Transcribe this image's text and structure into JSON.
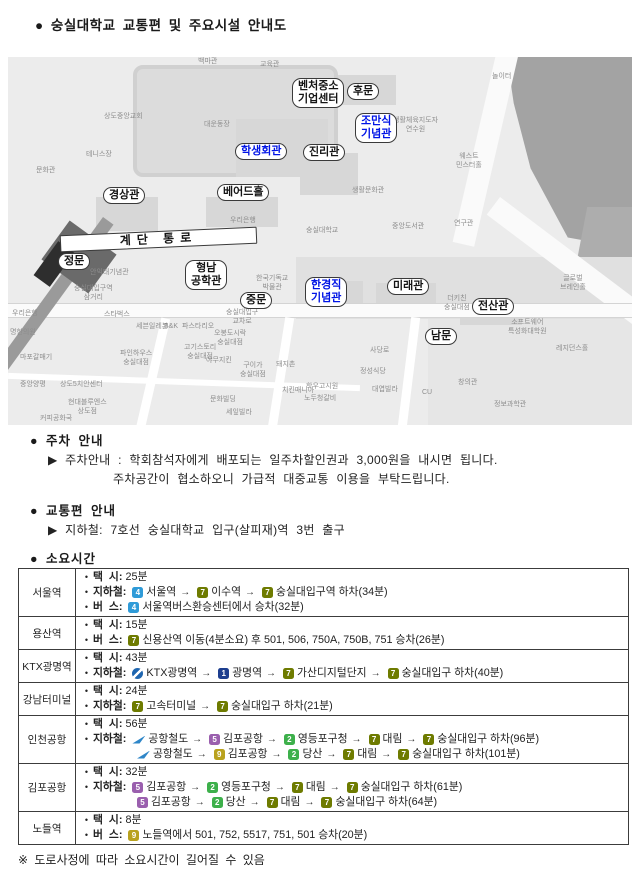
{
  "title": "● 숭실대학교 교통편 및 주요시설 안내도",
  "sections": {
    "parking": {
      "header": "● 주차 안내",
      "line1": "▶ 주차안내 : 학회참석자에게 배포되는 일주차할인권과 3,000원을 내시면 됩니다.",
      "line2": "주차공간이 협소하오니 가급적 대중교통 이용을 부탁드립니다."
    },
    "transport": {
      "header": "● 교통편 안내",
      "line1": "▶ 지하철: 7호선 숭실대학교 입구(살피재)역 3번 출구"
    },
    "duration": {
      "header": "● 소요시간"
    }
  },
  "footnote": "※ 도로사정에 따라 소요시간이 길어질 수 있음",
  "line_colors": {
    "1": "#1d3e8f",
    "2": "#3db04b",
    "4": "#2f9bd8",
    "5": "#9a5fae",
    "7": "#6e7b00",
    "9": "#b9a21e"
  },
  "map": {
    "highlight_color": "#0014e6",
    "boxes": [
      {
        "x": 284,
        "y": 21,
        "t": "벤처중소\n기업센터"
      },
      {
        "x": 339,
        "y": 26,
        "t": "후문"
      },
      {
        "x": 347,
        "y": 56,
        "t": "조만식\n기념관",
        "blue": true
      },
      {
        "x": 227,
        "y": 86,
        "t": "학생회관",
        "blue": true
      },
      {
        "x": 295,
        "y": 87,
        "t": "진리관"
      },
      {
        "x": 95,
        "y": 130,
        "t": "경상관"
      },
      {
        "x": 209,
        "y": 127,
        "t": "베어드홀"
      },
      {
        "x": 52,
        "y": 174,
        "w": 197,
        "t": "계단 통로",
        "banner": true
      },
      {
        "x": 50,
        "y": 196,
        "t": "정문"
      },
      {
        "x": 177,
        "y": 203,
        "t": "형남\n공학관"
      },
      {
        "x": 232,
        "y": 235,
        "t": "중문"
      },
      {
        "x": 297,
        "y": 220,
        "t": "한경직\n기념관",
        "blue": true
      },
      {
        "x": 379,
        "y": 221,
        "t": "미래관"
      },
      {
        "x": 464,
        "y": 241,
        "t": "전산관"
      },
      {
        "x": 417,
        "y": 271,
        "t": "남문"
      }
    ],
    "bg_labels": [
      {
        "x": 190,
        "y": 1,
        "t": "백마관"
      },
      {
        "x": 252,
        "y": 4,
        "t": "교육관"
      },
      {
        "x": 96,
        "y": 56,
        "t": "상도중앙교회"
      },
      {
        "x": 196,
        "y": 64,
        "t": "대운동장"
      },
      {
        "x": 78,
        "y": 94,
        "t": "테니스장"
      },
      {
        "x": 28,
        "y": 110,
        "t": "문화관"
      },
      {
        "x": 484,
        "y": 16,
        "t": "놀이터"
      },
      {
        "x": 385,
        "y": 60,
        "t": "생활체육지도자\n연수원"
      },
      {
        "x": 448,
        "y": 96,
        "t": "웨스트\n민스터홀"
      },
      {
        "x": 344,
        "y": 130,
        "t": "생활문화관"
      },
      {
        "x": 384,
        "y": 166,
        "t": "중앙도서관"
      },
      {
        "x": 446,
        "y": 163,
        "t": "연구관"
      },
      {
        "x": 222,
        "y": 160,
        "t": "우리은행"
      },
      {
        "x": 298,
        "y": 170,
        "t": "숭실대학교"
      },
      {
        "x": 82,
        "y": 212,
        "t": "안익태기념관"
      },
      {
        "x": 66,
        "y": 228,
        "t": "숭실대입구역\n삼거리"
      },
      {
        "x": 248,
        "y": 218,
        "t": "한국기독교\n박물관"
      },
      {
        "x": 218,
        "y": 252,
        "t": "숭실대입구\n교차로"
      },
      {
        "x": 96,
        "y": 254,
        "t": "스타벅스"
      },
      {
        "x": 552,
        "y": 218,
        "t": "글로벌\n브레인홀"
      },
      {
        "x": 500,
        "y": 262,
        "t": "소프트웨어\n특성화대학원"
      },
      {
        "x": 548,
        "y": 288,
        "t": "레지던스홀"
      },
      {
        "x": 436,
        "y": 238,
        "t": "더키친\n숭실대점"
      },
      {
        "x": 362,
        "y": 290,
        "t": "사당로"
      },
      {
        "x": 4,
        "y": 253,
        "t": "우리은행"
      },
      {
        "x": 2,
        "y": 272,
        "t": "명한의원"
      },
      {
        "x": 12,
        "y": 297,
        "t": "마포갈매기"
      },
      {
        "x": 12,
        "y": 324,
        "t": "중앙양평"
      },
      {
        "x": 52,
        "y": 324,
        "t": "상도5치안센터"
      },
      {
        "x": 60,
        "y": 342,
        "t": "현대블루엔스\n상도점"
      },
      {
        "x": 32,
        "y": 358,
        "t": "커피공화국"
      },
      {
        "x": 128,
        "y": 266,
        "t": "세븐일레븐"
      },
      {
        "x": 156,
        "y": 266,
        "t": "B&K"
      },
      {
        "x": 174,
        "y": 266,
        "t": "파스타리오"
      },
      {
        "x": 206,
        "y": 273,
        "t": "오봉도시락\n숭실대점"
      },
      {
        "x": 176,
        "y": 287,
        "t": "고기스토리\n숭실대점"
      },
      {
        "x": 198,
        "y": 300,
        "t": "야무지킨"
      },
      {
        "x": 232,
        "y": 305,
        "t": "구이가\n숭실대점"
      },
      {
        "x": 268,
        "y": 304,
        "t": "돼지촌"
      },
      {
        "x": 112,
        "y": 293,
        "t": "파인하우스\n숭실대점"
      },
      {
        "x": 274,
        "y": 330,
        "t": "치킨매니아"
      },
      {
        "x": 296,
        "y": 338,
        "t": "노두청갈비"
      },
      {
        "x": 202,
        "y": 339,
        "t": "문화빌딩"
      },
      {
        "x": 298,
        "y": 326,
        "t": "학우고시원"
      },
      {
        "x": 352,
        "y": 311,
        "t": "정성식당"
      },
      {
        "x": 364,
        "y": 329,
        "t": "대엽빌라"
      },
      {
        "x": 218,
        "y": 352,
        "t": "세잎빌라"
      },
      {
        "x": 450,
        "y": 322,
        "t": "창의관"
      },
      {
        "x": 486,
        "y": 344,
        "t": "정보과학관"
      },
      {
        "x": 414,
        "y": 332,
        "t": "CU"
      }
    ]
  },
  "table": {
    "rows": [
      {
        "station": "서울역",
        "lines": [
          {
            "bullet": true,
            "label": "택  시:",
            "parts": [
              {
                "text": "25분"
              }
            ]
          },
          {
            "bullet": true,
            "label": "지하철:",
            "parts": [
              {
                "badge": "4"
              },
              {
                "text": "서울역"
              },
              {
                "arrow": "→"
              },
              {
                "badge": "7"
              },
              {
                "text": "이수역"
              },
              {
                "arrow": "→"
              },
              {
                "badge": "7"
              },
              {
                "text": "숭실대입구역 하차(34분)"
              }
            ]
          },
          {
            "bullet": true,
            "label": "버  스:",
            "parts": [
              {
                "badge": "4"
              },
              {
                "text": "서울역버스환승센터에서 승차(32분)"
              }
            ]
          }
        ]
      },
      {
        "station": "용산역",
        "lines": [
          {
            "bullet": true,
            "label": "택  시:",
            "parts": [
              {
                "text": "15분"
              }
            ]
          },
          {
            "bullet": true,
            "label": "버  스:",
            "parts": [
              {
                "badge": "7"
              },
              {
                "text": "신용산역 이동(4분소요) 후 501, 506, 750A, 750B, 751 승차(26분)"
              }
            ]
          }
        ]
      },
      {
        "station": "KTX광명역",
        "lines": [
          {
            "bullet": true,
            "label": "택  시:",
            "parts": [
              {
                "text": "43분"
              }
            ]
          },
          {
            "bullet": true,
            "label": "지하철:",
            "parts": [
              {
                "icon": "ktx"
              },
              {
                "text": "KTX광명역"
              },
              {
                "arrow": "→"
              },
              {
                "badge": "1"
              },
              {
                "text": "광명역"
              },
              {
                "arrow": "→"
              },
              {
                "badge": "7"
              },
              {
                "text": "가산디지털단지"
              },
              {
                "arrow": "→"
              },
              {
                "badge": "7"
              },
              {
                "text": "숭실대입구 하차(40분)"
              }
            ]
          }
        ]
      },
      {
        "station": "강남터미널",
        "lines": [
          {
            "bullet": true,
            "label": "택  시:",
            "parts": [
              {
                "text": "24분"
              }
            ]
          },
          {
            "bullet": true,
            "label": "지하철:",
            "parts": [
              {
                "badge": "7"
              },
              {
                "text": "고속터미널"
              },
              {
                "arrow": "→"
              },
              {
                "badge": "7"
              },
              {
                "text": "숭실대입구 하차(21분)"
              }
            ]
          }
        ]
      },
      {
        "station": "인천공항",
        "lines": [
          {
            "bullet": true,
            "label": "택  시:",
            "parts": [
              {
                "text": "56분"
              }
            ]
          },
          {
            "bullet": true,
            "label": "지하철:",
            "parts": [
              {
                "icon": "arex"
              },
              {
                "text": "공항철도"
              },
              {
                "arrow": "→"
              },
              {
                "badge": "5"
              },
              {
                "text": "김포공항"
              },
              {
                "arrow": "→"
              },
              {
                "badge": "2"
              },
              {
                "text": "영등포구청"
              },
              {
                "arrow": "→"
              },
              {
                "badge": "7"
              },
              {
                "text": "대림"
              },
              {
                "arrow": "→"
              },
              {
                "badge": "7"
              },
              {
                "text": "숭실대입구 하차(96분)"
              }
            ]
          },
          {
            "bullet": false,
            "label": "",
            "parts": [
              {
                "icon": "arex"
              },
              {
                "text": "공항철도"
              },
              {
                "arrow": "→"
              },
              {
                "badge": "9"
              },
              {
                "text": "김포공항"
              },
              {
                "arrow": "→"
              },
              {
                "badge": "2"
              },
              {
                "text": "당산"
              },
              {
                "arrow": "→"
              },
              {
                "badge": "7"
              },
              {
                "text": "대림"
              },
              {
                "arrow": "→"
              },
              {
                "badge": "7"
              },
              {
                "text": "숭실대입구 하차(101분)"
              }
            ]
          }
        ]
      },
      {
        "station": "김포공항",
        "lines": [
          {
            "bullet": true,
            "label": "택  시:",
            "parts": [
              {
                "text": "32분"
              }
            ]
          },
          {
            "bullet": true,
            "label": "지하철:",
            "parts": [
              {
                "badge": "5"
              },
              {
                "text": "김포공항"
              },
              {
                "arrow": "→"
              },
              {
                "badge": "2"
              },
              {
                "text": "영등포구청"
              },
              {
                "arrow": "→"
              },
              {
                "badge": "7"
              },
              {
                "text": "대림"
              },
              {
                "arrow": "→"
              },
              {
                "badge": "7"
              },
              {
                "text": "숭실대입구 하차(61분)"
              }
            ]
          },
          {
            "bullet": false,
            "label": "",
            "parts": [
              {
                "badge": "5"
              },
              {
                "text": "김포공항"
              },
              {
                "arrow": "→"
              },
              {
                "badge": "2"
              },
              {
                "text": "당산"
              },
              {
                "arrow": "→"
              },
              {
                "badge": "7"
              },
              {
                "text": "대림"
              },
              {
                "arrow": "→"
              },
              {
                "badge": "7"
              },
              {
                "text": "숭실대입구 하차(64분)"
              }
            ]
          }
        ]
      },
      {
        "station": "노들역",
        "lines": [
          {
            "bullet": true,
            "label": "택  시:",
            "parts": [
              {
                "text": "8분"
              }
            ]
          },
          {
            "bullet": true,
            "label": "버  스:",
            "parts": [
              {
                "badge": "9"
              },
              {
                "text": "노들역에서 501, 752, 5517, 751, 501 승차(20분)"
              }
            ]
          }
        ]
      }
    ]
  }
}
